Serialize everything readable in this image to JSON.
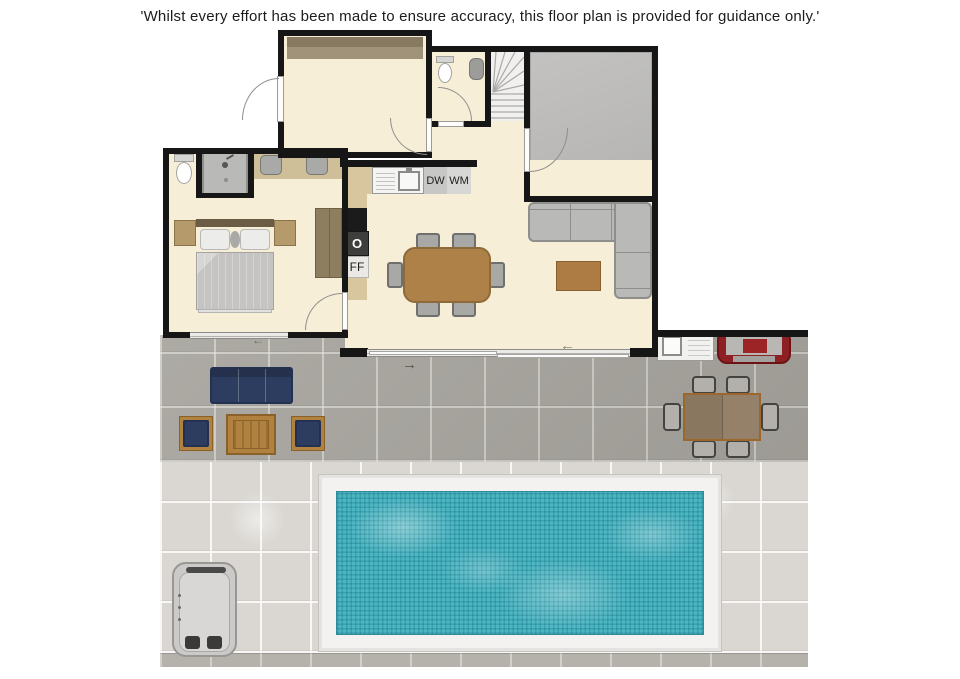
{
  "disclaimer": "'Whilst every effort has been made to ensure accuracy, this floor plan is provided for guidance only.'",
  "appliance_labels": {
    "dishwasher": "DW",
    "washing_machine": "WM",
    "oven": "O",
    "fridge_freezer": "FF"
  },
  "icons": {
    "slide_arrow_left": "←",
    "slide_arrow_right": "→"
  },
  "palette": {
    "wall": "#161616",
    "room_fill": "#f6eed7",
    "garage_fill": "#bdbcba",
    "wardrobe_brown": "#8e8165",
    "patio_tile": "#a7a49e",
    "deck_tile": "#dad7d2",
    "pool_water": "#4cb6c3",
    "pool_frame": "#f3f2f0",
    "outdoor_navy": "#2d3d5f",
    "wood": "#b0813f",
    "bbq_red": "#8e2023",
    "sofa_gray": "#b9b9b7"
  }
}
